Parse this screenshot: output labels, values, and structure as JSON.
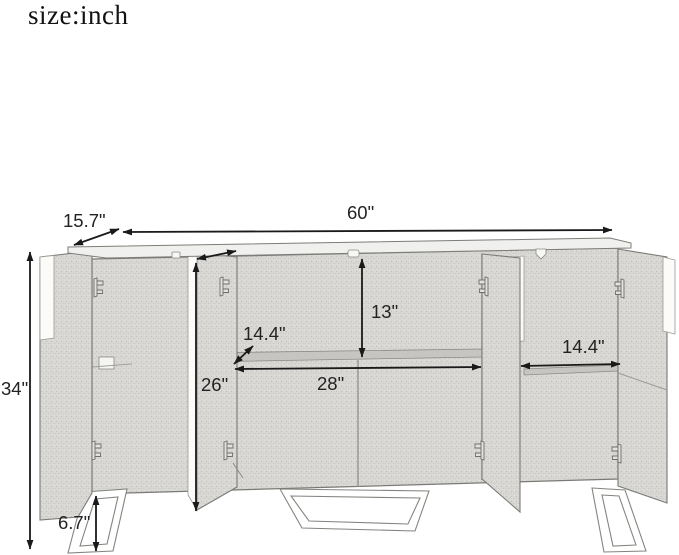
{
  "page": {
    "title": "size:inch",
    "background": "#ffffff"
  },
  "diagram": {
    "subject": "sideboard-cabinet-with-open-doors",
    "ink_color": "#1a1a1a",
    "label_color": "#232323",
    "wood_speckle_color": "#d7d6d3",
    "shelf_band_color": "#c6c5c1",
    "edge_color": "#7a7a76",
    "measurements": [
      {
        "name": "overall-width",
        "label": "60\"",
        "x1": 123,
        "y1": 232,
        "x2": 612,
        "y2": 230,
        "lx": 347,
        "ly": 219
      },
      {
        "name": "top-depth",
        "label": "15.7\"",
        "x1": 74,
        "y1": 245,
        "x2": 119,
        "y2": 229,
        "lx": 63,
        "ly": 227
      },
      {
        "name": "overall-height",
        "label": "34\"",
        "x1": 30,
        "y1": 252,
        "x2": 30,
        "y2": 549,
        "lx": 1,
        "ly": 395
      },
      {
        "name": "upper-compartment-height",
        "label": "13\"",
        "x1": 362,
        "y1": 259,
        "x2": 362,
        "y2": 357,
        "lx": 371,
        "ly": 318
      },
      {
        "name": "door-open-depth",
        "label": "",
        "x1": 197,
        "y1": 259,
        "x2": 236,
        "y2": 251,
        "lx": 0,
        "ly": 0
      },
      {
        "name": "shelf-depth",
        "label": "14.4\"",
        "x1": 234,
        "y1": 364,
        "x2": 253,
        "y2": 346,
        "lx": 243,
        "ly": 340
      },
      {
        "name": "interior-height",
        "label": "26\"",
        "x1": 196,
        "y1": 263,
        "x2": 196,
        "y2": 511,
        "lx": 201,
        "ly": 391
      },
      {
        "name": "middle-interior-width",
        "label": "28\"",
        "x1": 235,
        "y1": 369,
        "x2": 481,
        "y2": 367,
        "lx": 317,
        "ly": 390
      },
      {
        "name": "side-interior-width",
        "label": "14.4\"",
        "x1": 521,
        "y1": 366,
        "x2": 620,
        "y2": 364,
        "lx": 562,
        "ly": 353
      },
      {
        "name": "leg-height",
        "label": "6.7\"",
        "x1": 96,
        "y1": 496,
        "x2": 96,
        "y2": 551,
        "lx": 58,
        "ly": 529
      }
    ]
  }
}
